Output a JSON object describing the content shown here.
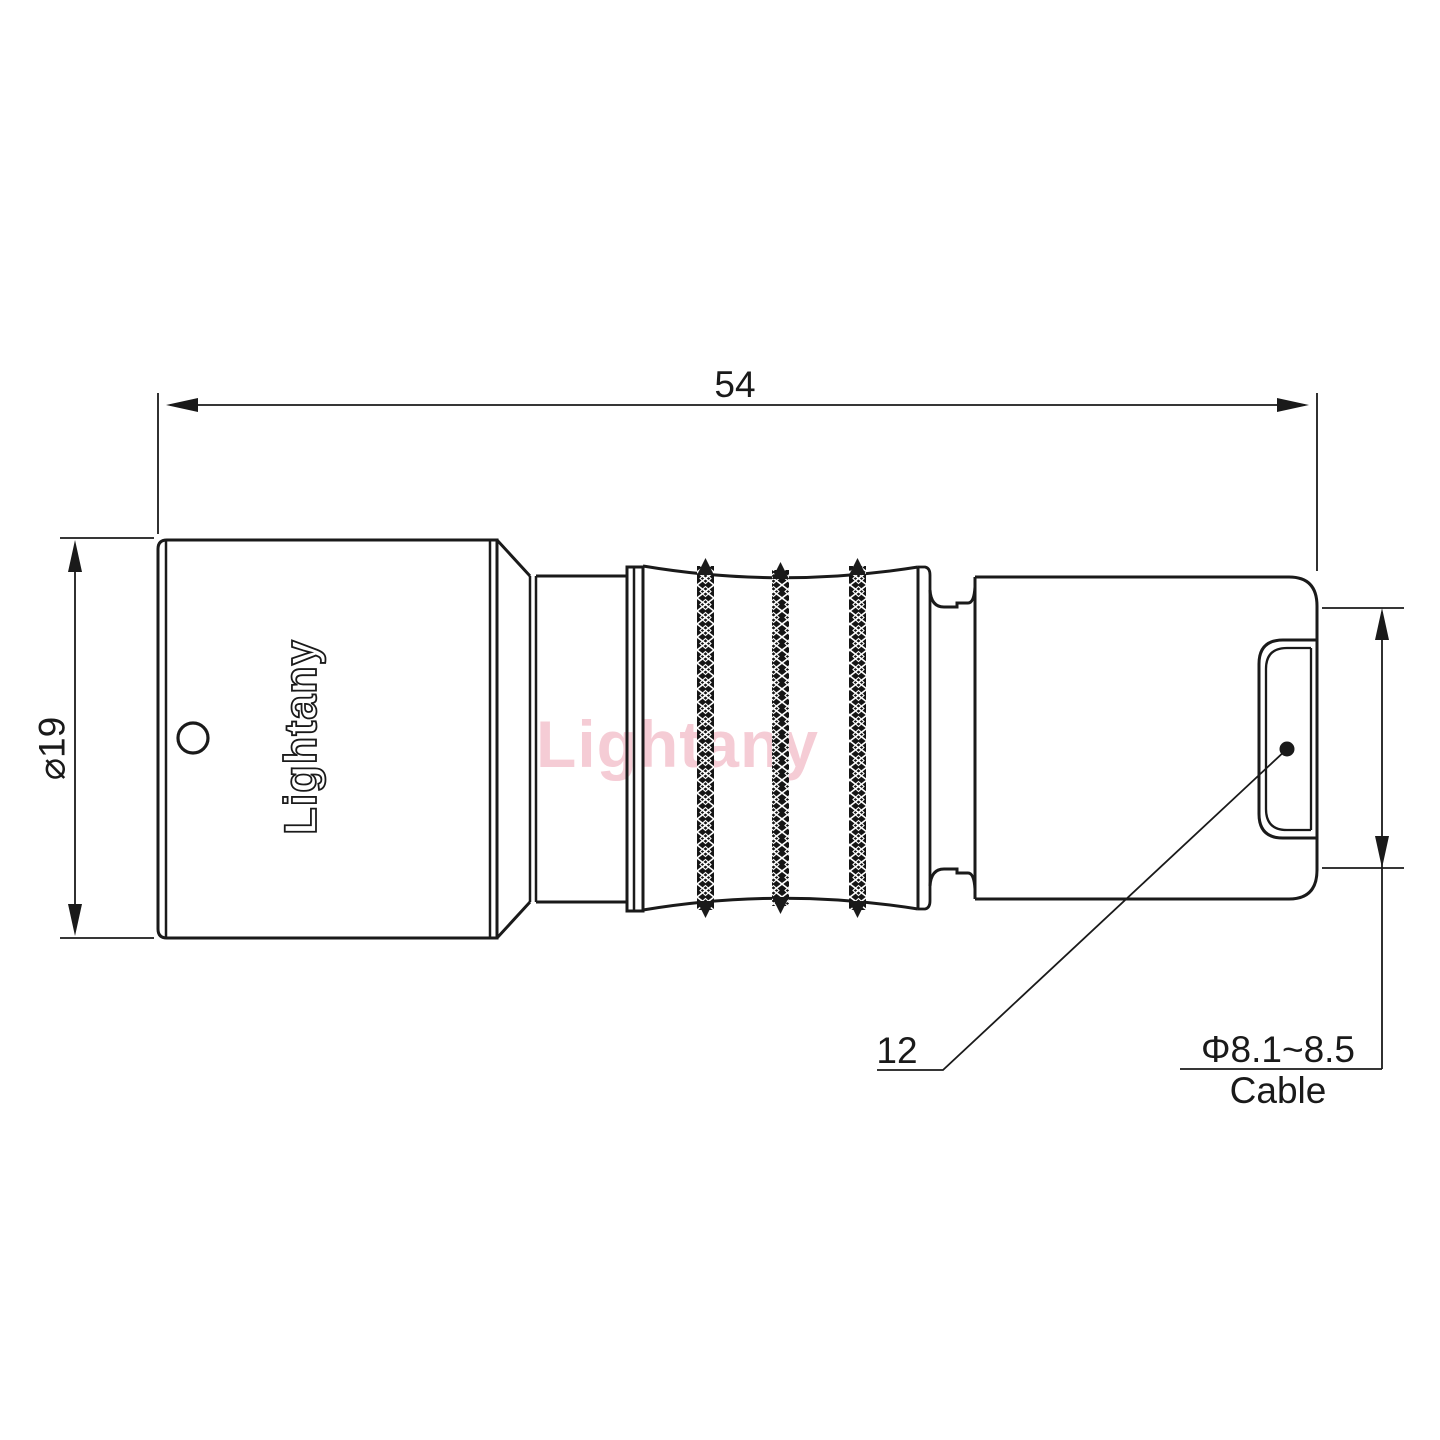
{
  "theme": {
    "line_color": "#1a1a1a",
    "background": "#ffffff",
    "watermark_color": "rgba(225,110,135,0.35)"
  },
  "labels": {
    "overall_length": "54",
    "body_diameter": "⌀19",
    "bushing_ref": "12",
    "cable_range": "Φ8.1~8.5",
    "cable_word": "Cable"
  },
  "branding": {
    "engraving": "Lightany",
    "watermark": "Lightany"
  }
}
